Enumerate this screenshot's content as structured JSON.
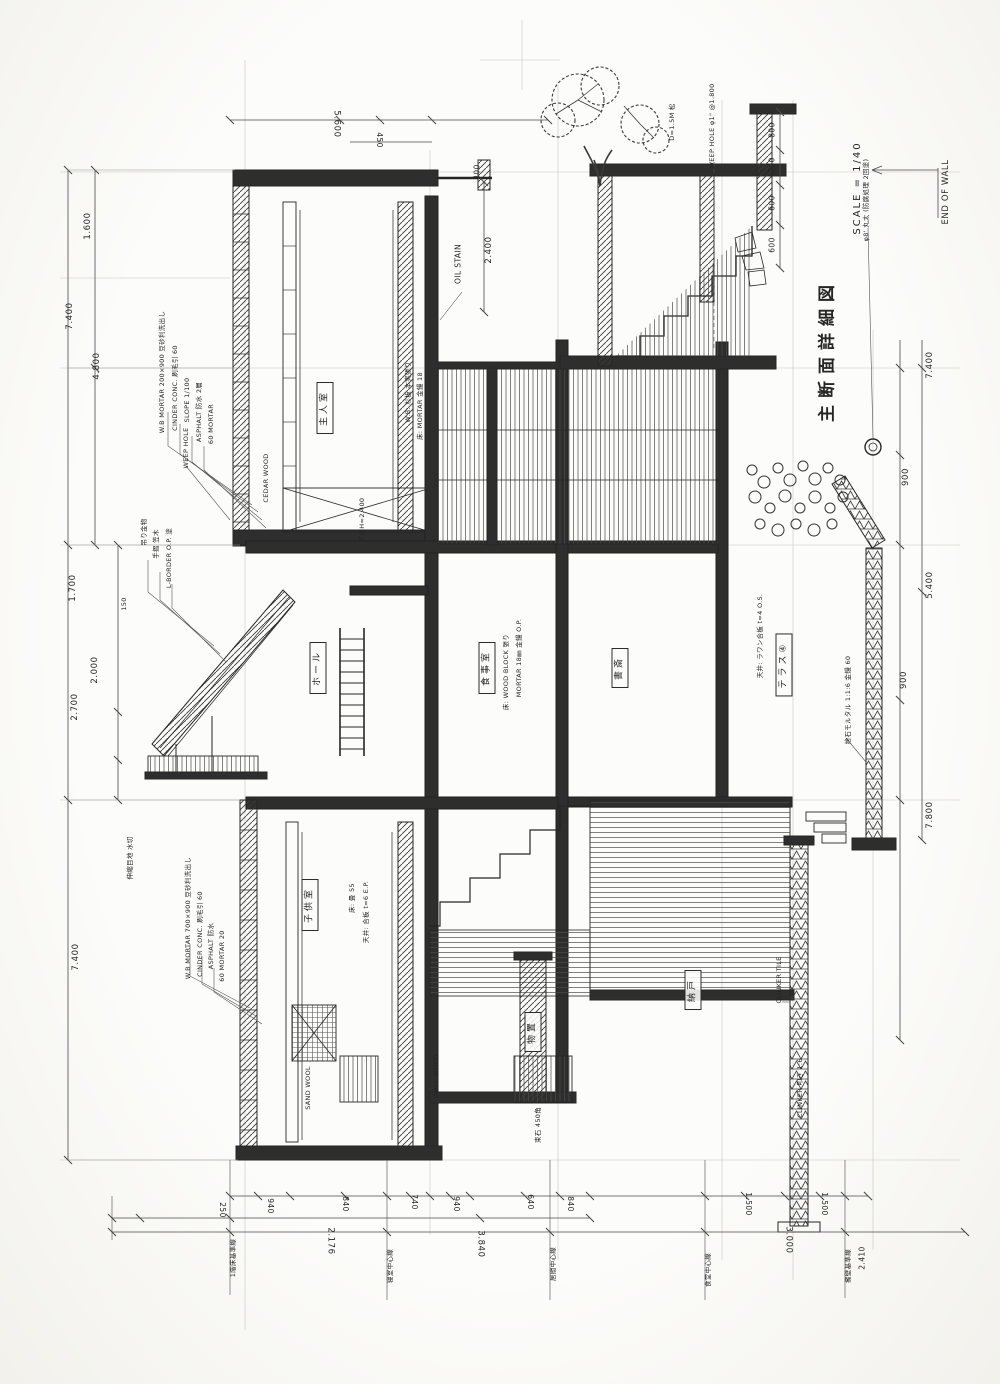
{
  "title": {
    "main": "主断面詳細図",
    "scale": "SCALE = 1/40",
    "end_of_wall": "END OF WALL"
  },
  "colors": {
    "ink": "#2b2b2b",
    "paper": "#fafaf8"
  },
  "rooms": {
    "master": "主人室",
    "hall": "ホール",
    "dining": "食事室",
    "study": "書斎",
    "terrace": "テラス④",
    "child": "子供室",
    "store": "納戸",
    "cellar": "物置"
  },
  "dims": {
    "left": [
      "1.600",
      "7.400",
      "4.800",
      "1.700",
      "2.000",
      "2.700",
      "7.400",
      "150"
    ],
    "right": [
      "7.400",
      "900",
      "5.400",
      "900",
      "7.800"
    ],
    "top": [
      "5.600",
      "450",
      "400",
      "2.400"
    ],
    "top_right_stack": [
      "800",
      "200",
      "600",
      "600"
    ],
    "bottom_small": [
      "250",
      "940",
      "840",
      "740",
      "940",
      "640",
      "840",
      "1.500",
      "1.500"
    ],
    "bottom_large": [
      "2.176",
      "3.840",
      "3.000",
      "2.410"
    ]
  },
  "grid_labels": [
    "1階床基準線",
    "寝室中心線",
    "居間中心線",
    "食堂中心線",
    "擁壁基準線"
  ],
  "annotations": {
    "a1": "W.B MORTAR 200×900 豆砂利洗出し",
    "a2": "CINDER CONC. 刷毛引 60",
    "a3": "SLOPE 1/100",
    "a4": "ASPHALT 防水 2層",
    "a5": "60 MORTAR",
    "a6": "吊り金物",
    "a7": "手摺 笠木",
    "a8": "L-BORDER O.P. 塗",
    "a9": "WEEP HOLE",
    "a10": "伸縮目地 水切",
    "a11": "W.B MORTAR 700×900 豆砂利洗出し",
    "a12": "CINDER CONC. 刷毛引 60",
    "a13": "ASPHALT 防水",
    "a14": "60 MORTAR 20",
    "a15": "D=1.5M 松",
    "a16": "WEEP HOLE φ1\" @1.800",
    "a17": "φ8' 丸太 (防腐処理 2回塗)",
    "a18": "捨石モルタル 1:1:6 金鏝 60",
    "a19": "CLINKER TILE",
    "a20": "CLINKER 叩き 1:6",
    "a21": "OIL STAIN",
    "a22": "床: WOOD BLOCK 張り",
    "a23": "MORTAR 18㎜ 金鏝 O.P.",
    "a24": "天井: ラワン合板 t=4 O.S.",
    "a25": "床: 畳 55",
    "a26": "天井: 合板 t=6 E.P.",
    "a27": "W.B: 杉板 本実張り",
    "a28": "床: MORTAR 金鏝 18",
    "a29": "天井H=2.400",
    "a30": "SAND WOOL",
    "a31": "束石 450角",
    "a32": "WALL WOOD",
    "a33": "CEDAR WOOD"
  }
}
